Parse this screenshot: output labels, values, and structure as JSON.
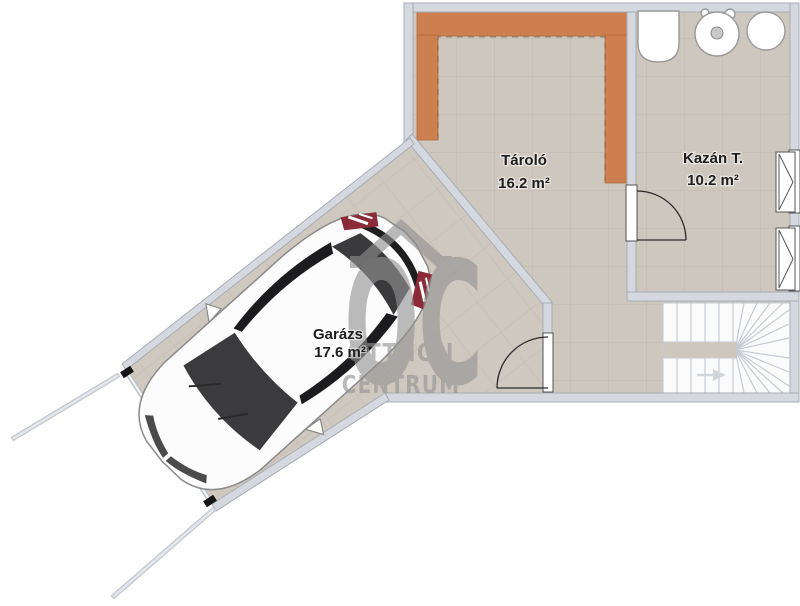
{
  "plan": {
    "rooms": [
      {
        "name": "Tároló",
        "area": "16.2 m²"
      },
      {
        "name": "Kazán T.",
        "area": "10.2 m²"
      },
      {
        "name": "Garázs",
        "area": "17.6 m²"
      }
    ],
    "watermark": {
      "monogram": "OC",
      "line1": "OTTHON",
      "line2": "CENTRUM"
    },
    "colors": {
      "floor_tan": "#cec7be",
      "tile_line": "#c2b9af",
      "wall_fill": "#d5d9df",
      "wall_edge": "#a6acb4",
      "accent_orange": "#cd7f4f",
      "orange_edge": "#b06a3e",
      "stair_white": "#fbfbfc",
      "watermark_gray": "#939393",
      "car_window_dark": "#3b3b3d",
      "tail_light_red": "#8c2b38"
    }
  }
}
